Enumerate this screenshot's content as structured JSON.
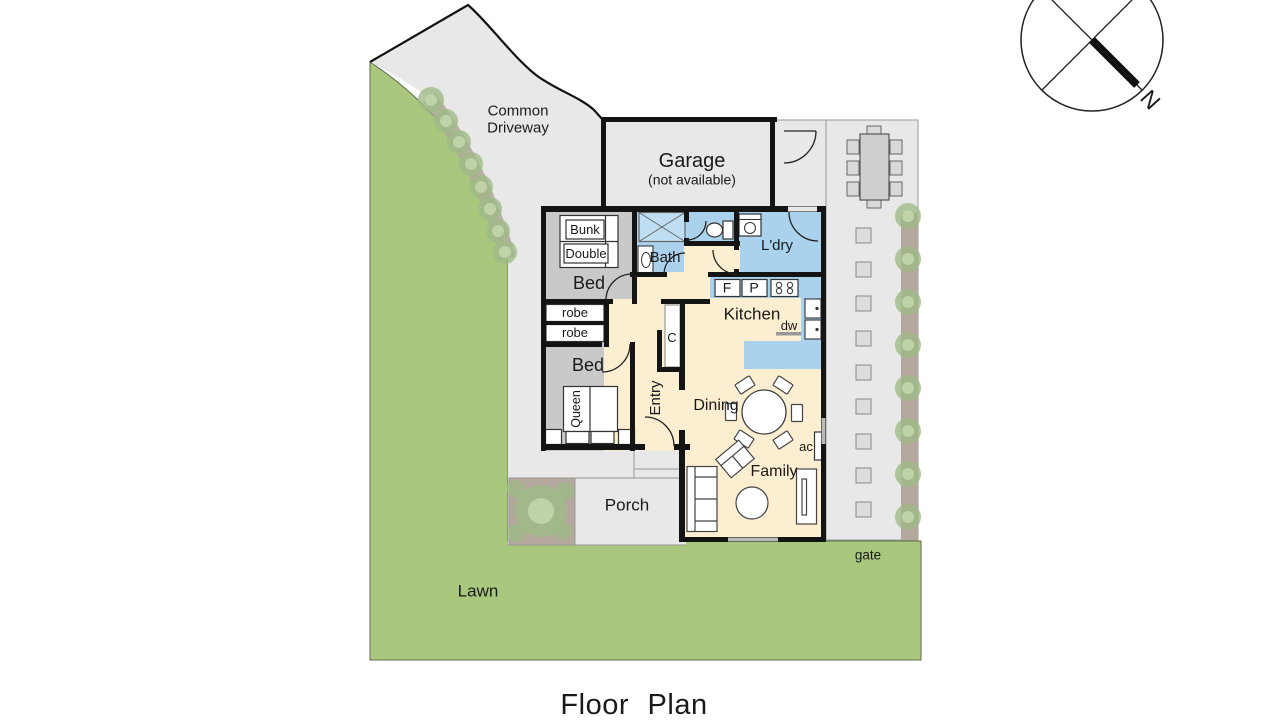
{
  "page": {
    "title": "Floor Plan"
  },
  "compass": {
    "north_label": "N"
  },
  "site": {
    "common_driveway_line1": "Common",
    "common_driveway_line2": "Driveway",
    "lawn": "Lawn",
    "gate": "gate",
    "porch": "Porch"
  },
  "garage": {
    "label": "Garage",
    "note": "(not available)"
  },
  "rooms": {
    "bedroom_front": {
      "label": "Bed"
    },
    "bedroom_rear": {
      "label": "Bed"
    },
    "bathroom": {
      "label": "Bath"
    },
    "laundry": {
      "label": "L'dry"
    },
    "kitchen": {
      "label": "Kitchen"
    },
    "entry": {
      "label": "Entry"
    },
    "dining": {
      "label": "Dining"
    },
    "family": {
      "label": "Family"
    }
  },
  "fixtures": {
    "bunk_bed": "Bunk",
    "double_bed": "Double",
    "queen_bed": "Queen",
    "robe_front": "robe",
    "robe_rear": "robe",
    "closet": "C",
    "fridge": "F",
    "pantry": "P",
    "dishwasher": "dw",
    "air_conditioner": "ac"
  },
  "colors": {
    "lawn": "#a9c87e",
    "paving": "#e8e8e8",
    "bedroom_floor": "#c9c9c9",
    "wet_area_floor": "#aad2ec",
    "living_floor": "#fcefd1",
    "garden_bed": "#b4a79d",
    "tree": "#9fba87",
    "wall": "#141414"
  }
}
